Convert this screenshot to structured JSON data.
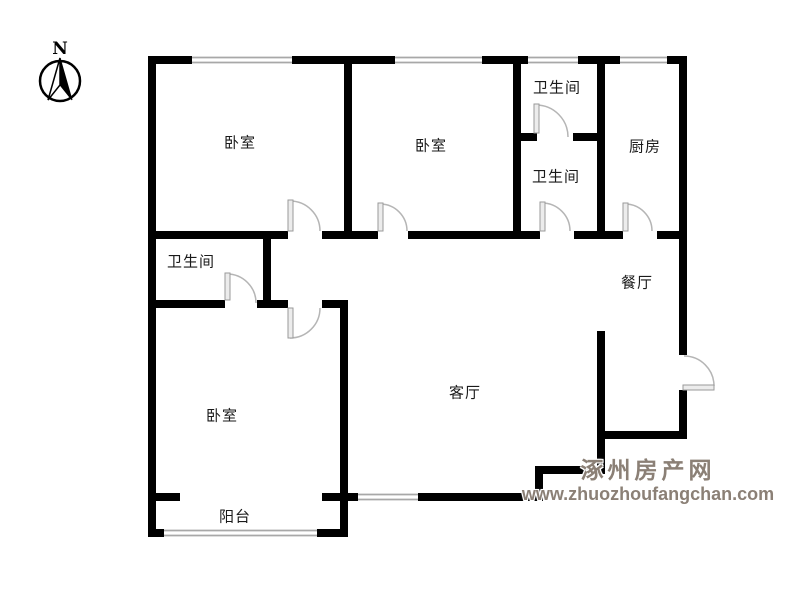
{
  "compass": {
    "label": "N"
  },
  "rooms": [
    {
      "id": "bedroom-top-left",
      "label": "卧室"
    },
    {
      "id": "bedroom-top-middle",
      "label": "卧室"
    },
    {
      "id": "bathroom-top",
      "label": "卫生间"
    },
    {
      "id": "bathroom-middle",
      "label": "卫生间"
    },
    {
      "id": "kitchen",
      "label": "厨房"
    },
    {
      "id": "dining-room",
      "label": "餐厅"
    },
    {
      "id": "living-room",
      "label": "客厅"
    },
    {
      "id": "bathroom-left",
      "label": "卫生间"
    },
    {
      "id": "bedroom-bottom-left",
      "label": "卧室"
    },
    {
      "id": "balcony",
      "label": "阳台"
    }
  ],
  "watermark": {
    "site_name": "涿州房产网",
    "url": "www.zhuozhoufangchan.com"
  },
  "colors": {
    "wall": "#000000",
    "window_line": "#a8a8a8",
    "door_symbol": "#b5b5b5",
    "label_text": "#1a1a1a",
    "watermark_text": "#8b8076"
  }
}
